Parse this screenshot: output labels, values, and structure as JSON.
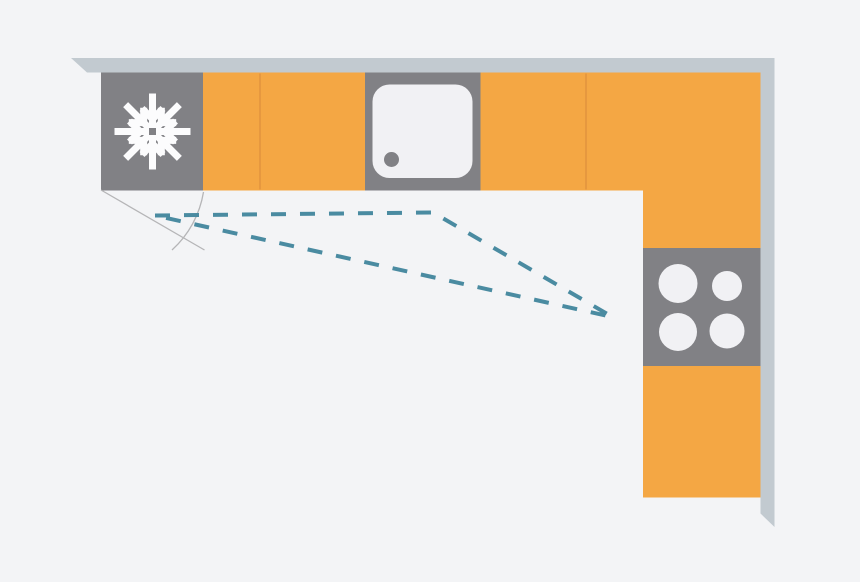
{
  "colors": {
    "background": "#f3f4f6",
    "wall": "#c2cad0",
    "cabinet": "#f4a744",
    "cabinet-divider": "#e2953e",
    "appliance": "#818185",
    "fixture-white": "#f1f1f4",
    "icon-white": "#fcfcfd",
    "work-triangle": "#4a8ba1",
    "door-swing": "#b5b5b7"
  },
  "diagram": {
    "type": "kitchen-floor-plan",
    "layout": "L-shaped",
    "work_triangle": {
      "style": "dashed",
      "points": "155,215.5 433,212.5 612.5,317",
      "vertices": [
        {
          "at": "fridge-freezer",
          "x": 155,
          "y": 215.5
        },
        {
          "at": "sink",
          "x": 433,
          "y": 212.5
        },
        {
          "at": "hob",
          "x": 612.5,
          "y": 317
        }
      ]
    },
    "door_swing": {
      "door_line_path": "M101,190 L204.5,250",
      "arc_path": "M203.5,192 A100,100 0 0 1 172,250"
    },
    "appliances": [
      {
        "name": "fridge-freezer",
        "icon": "snowflake-icon"
      },
      {
        "name": "sink",
        "features": [
          "basin",
          "drain"
        ]
      },
      {
        "name": "hob",
        "burners": 4
      }
    ]
  }
}
